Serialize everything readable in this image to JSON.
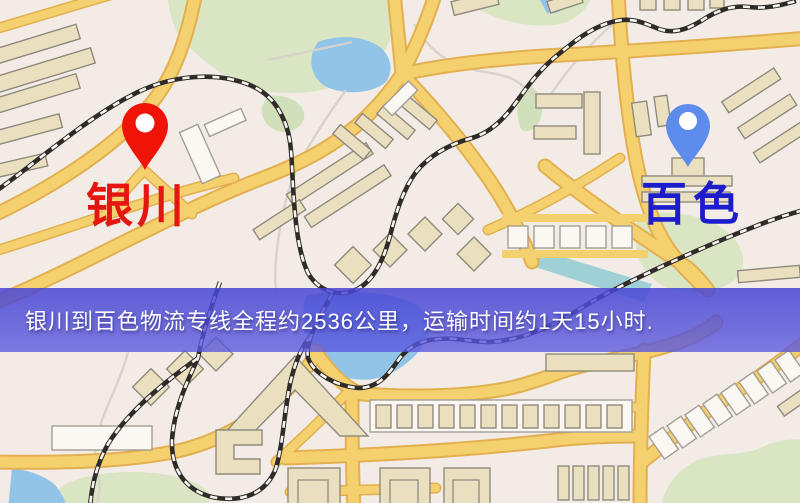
{
  "banner": {
    "text": "银川到百色物流专线全程约2536公里，运输时间约1天15小时.",
    "bg_color": "#4a48d4",
    "text_color": "#ffffff"
  },
  "markers": {
    "origin": {
      "label": "银川",
      "label_color": "#e51511",
      "pin_color": "#f01408"
    },
    "destination": {
      "label": "百色",
      "label_color": "#1c1ccc",
      "pin_color": "#5e8cec"
    }
  },
  "map_palette": {
    "background": "#f3ece6",
    "road": "#f5d06e",
    "road_edge": "#e3b050",
    "building": "#eae0c0",
    "building_outline": "#8f8a7d",
    "green_area": "#d9e5c3",
    "water": "#92c4e8",
    "railway": "#2e2b28"
  }
}
